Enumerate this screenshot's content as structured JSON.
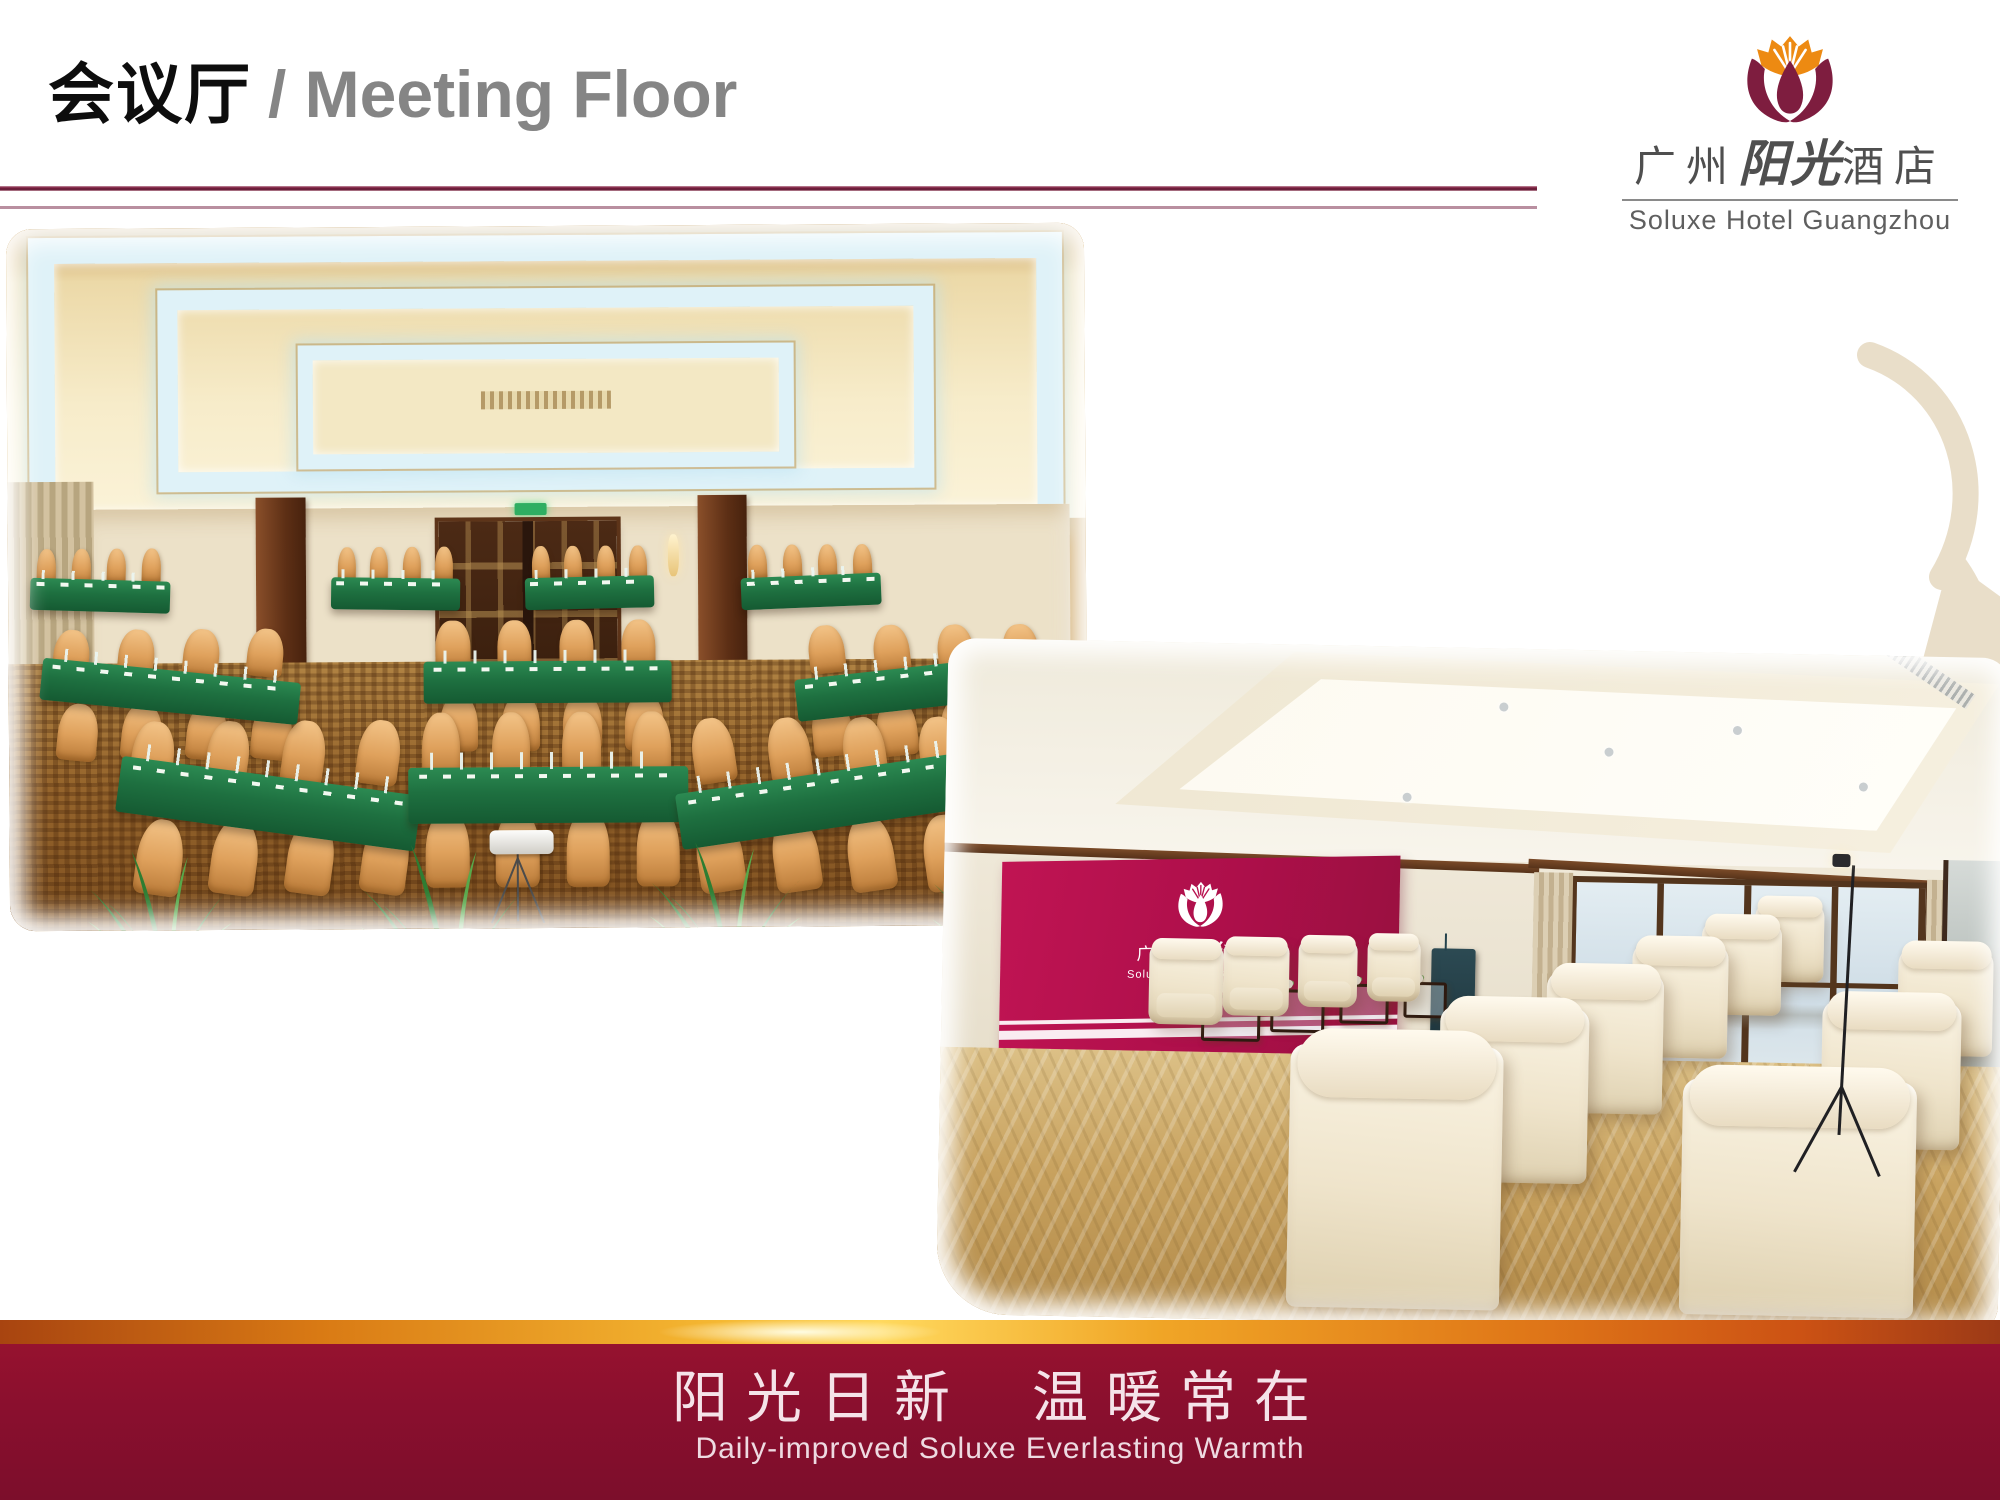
{
  "slide": {
    "title": {
      "zh": "会议厅",
      "en": "/ Meeting Floor"
    },
    "brand": {
      "flower_icon": "tulip-sunburst-icon",
      "name_zh_prefix": "广州",
      "name_zh_script": "阳光",
      "name_zh_suffix": "酒店",
      "name_en": "Soluxe Hotel Guangzhou"
    },
    "watermark_icon": "tulip-ornament-icon",
    "footer": {
      "slogan_zh_left": "阳光日新",
      "slogan_zh_right": "温暖常在",
      "slogan_en": "Daily-improved Soluxe Everlasting Warmth"
    },
    "colors": {
      "petal_maroon": "#7E1D3F",
      "crown_orange": "#ED8A12",
      "header_rule": "#7D2242",
      "title_gray": "#858585",
      "footer_maroon": "#8A0F2E",
      "gold_bar": "#F5B832",
      "magenta_wall": "#B8104E",
      "watermark_beige": "#E9DEC9",
      "table_green": "#1E7040",
      "chair_tan": "#DFA15C",
      "carpet_gold": "#C8A25F"
    }
  }
}
